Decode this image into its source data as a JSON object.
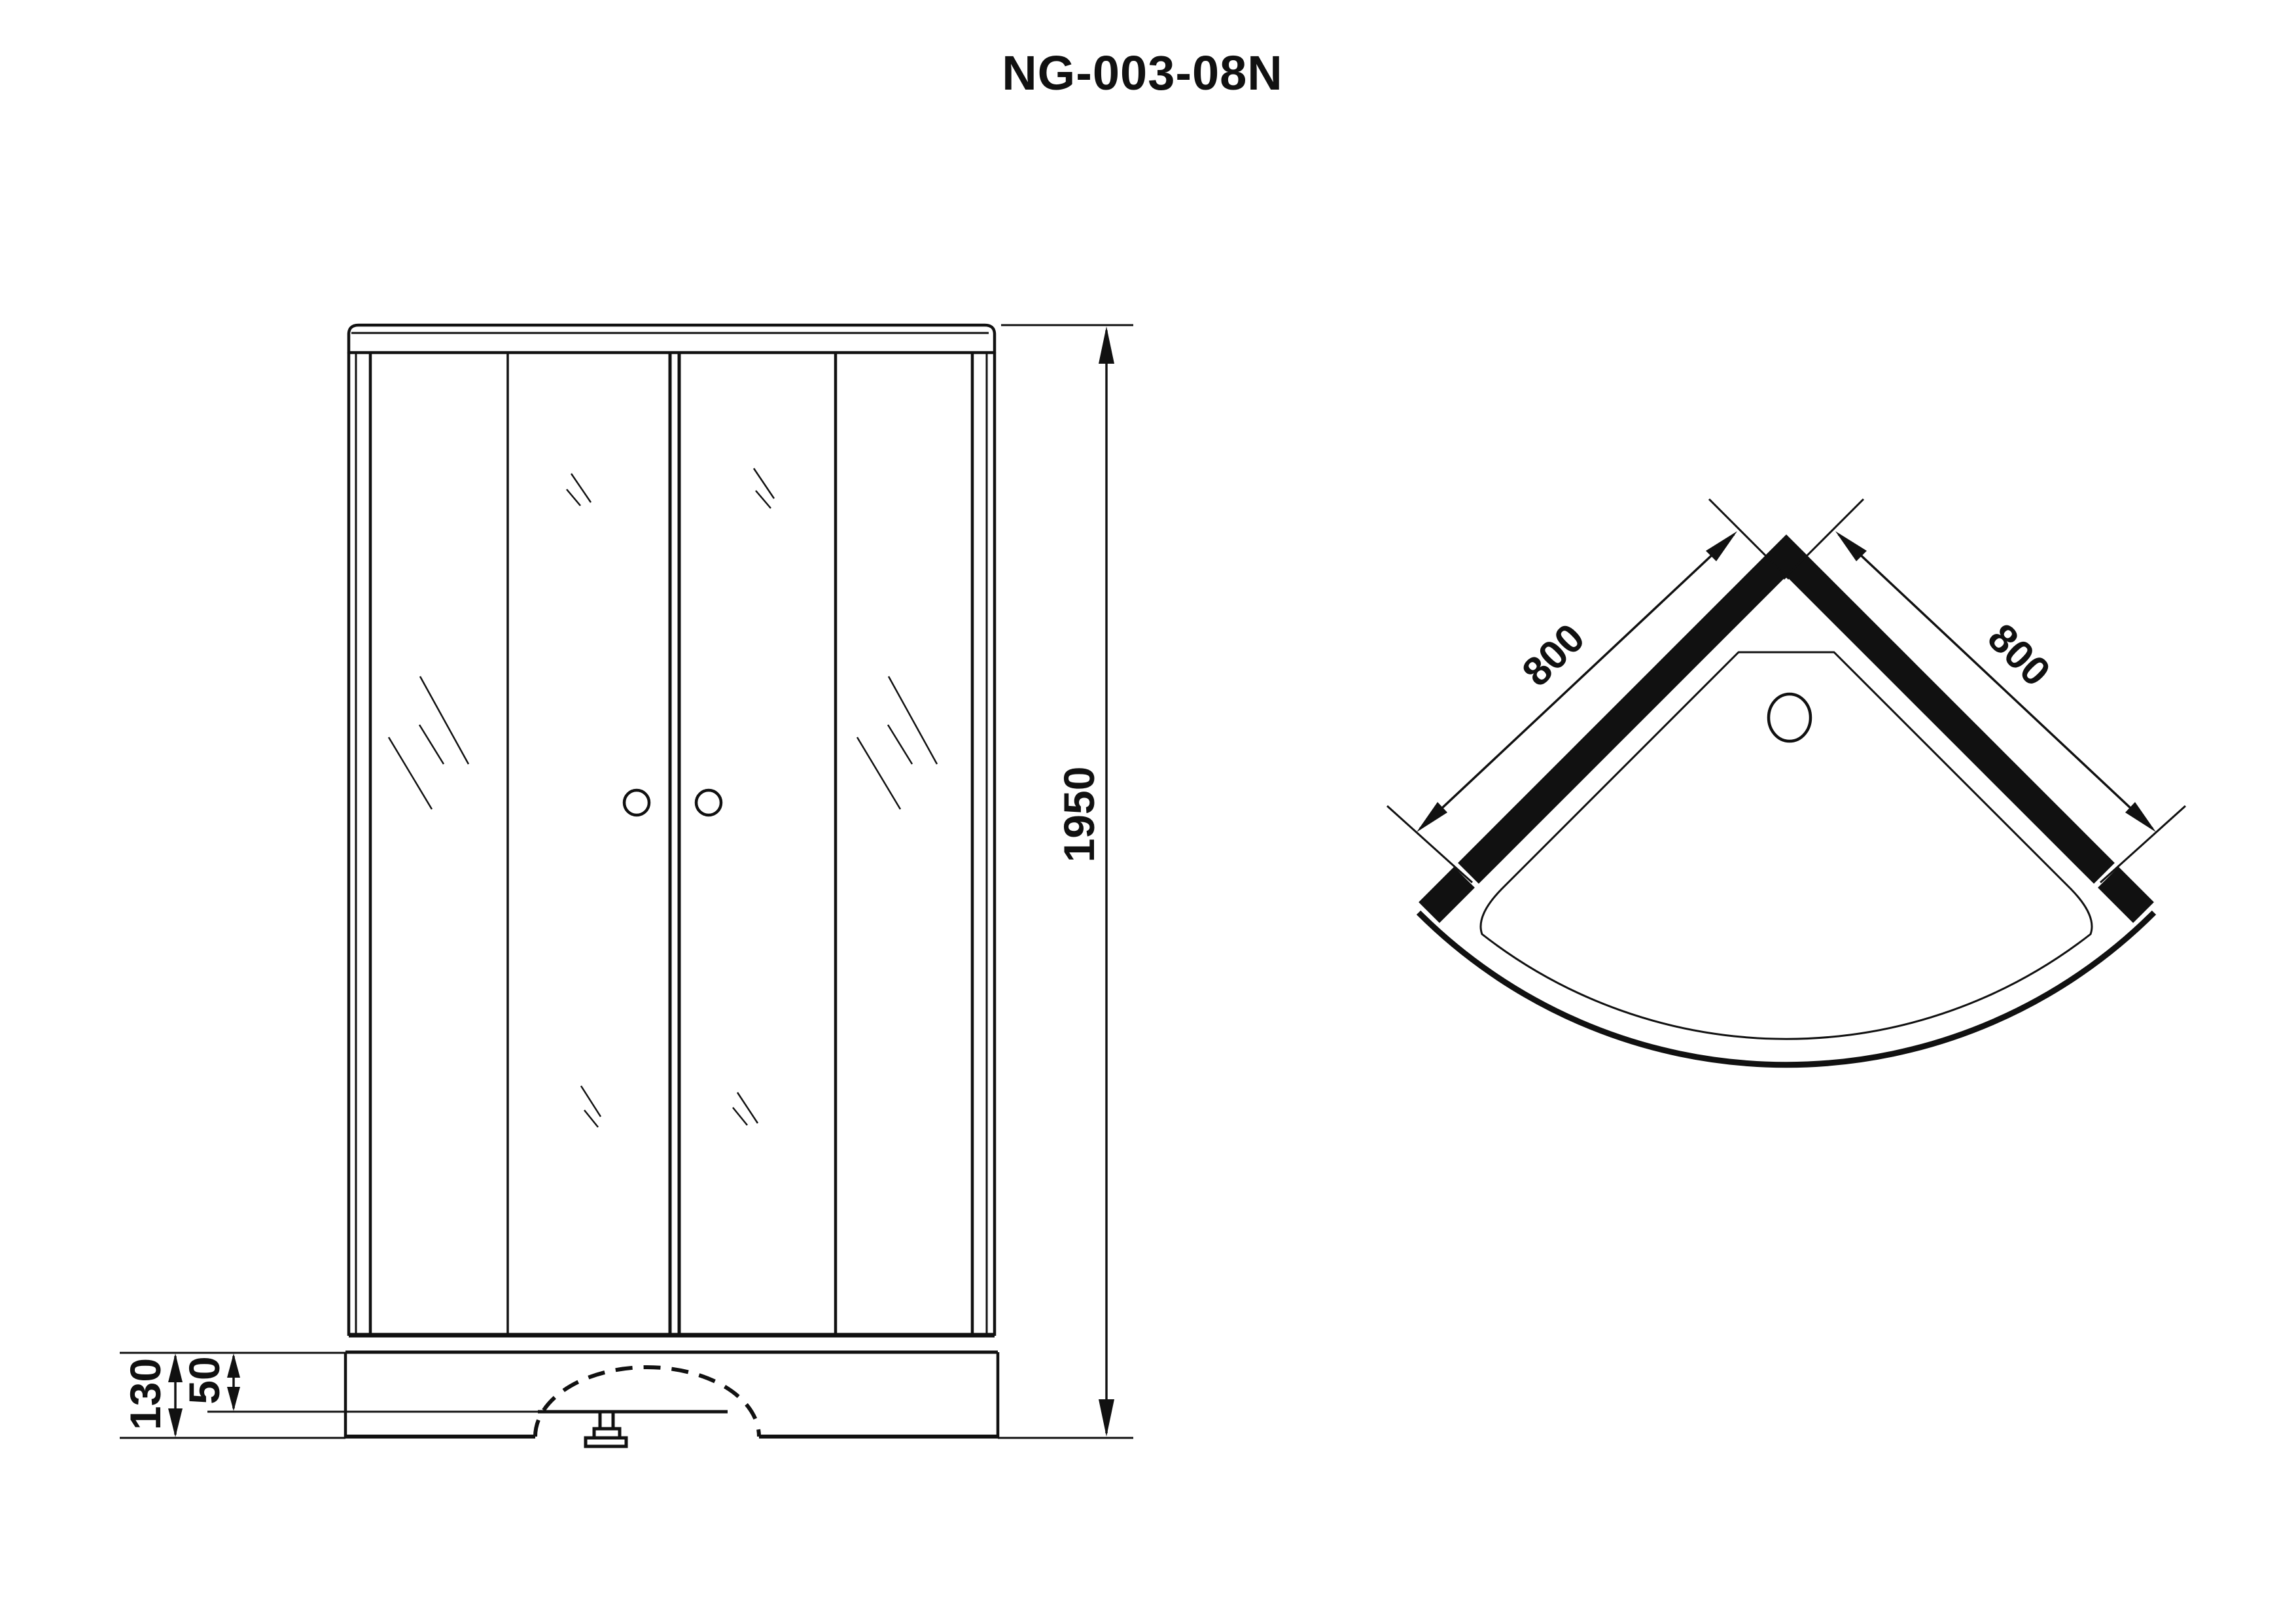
{
  "title": "NG-003-08N",
  "colors": {
    "ink": "#111111",
    "background": "#ffffff"
  },
  "views": {
    "front": {
      "name": "front-elevation",
      "dimensions": {
        "overall_height_mm": "1950",
        "base_height_mm": "130",
        "tray_rim_height_mm": "50"
      }
    },
    "plan": {
      "name": "top-plan",
      "dimensions": {
        "left_side_mm": "800",
        "right_side_mm": "800"
      }
    }
  }
}
